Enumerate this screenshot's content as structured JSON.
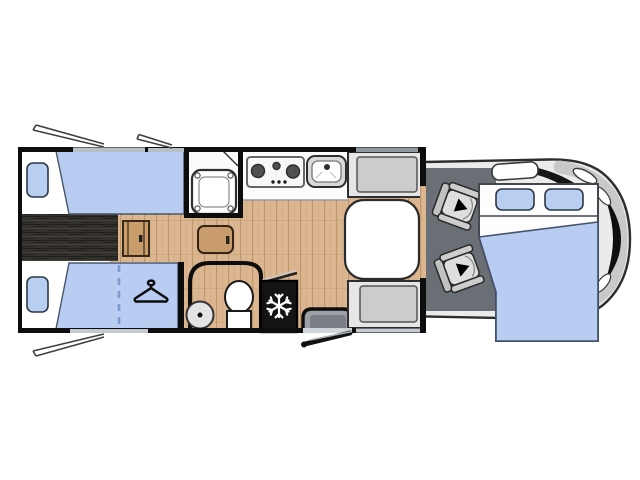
{
  "diagram": {
    "type": "motorhome-floorplan-top-view",
    "orientation": "vehicle front (cab) on the right, rear bedroom on the left",
    "colors": {
      "mattress_blue": "#b9cdf2",
      "wood_floor": "#dbb690",
      "dark_walkway": "#33312b",
      "wall_black": "#0d0d0d",
      "cab_body_gray": "#ebebeb",
      "cab_floor_gray": "#696f74",
      "bench_gray": "#cccccc",
      "fridge_black": "#141414",
      "window_sill_gray": "#c3c9cf"
    },
    "features": {
      "rear_bed_top": {
        "title": "Rear single bed (top)"
      },
      "rear_bed_bottom": {
        "title": "Rear single bed (bottom) with wardrobe under"
      },
      "rear_walkway": {
        "title": "Dark step walkway between rear beds"
      },
      "wardrobe": {
        "title": "Wardrobe (hanger symbol)"
      },
      "shower": {
        "title": "Shower cabin"
      },
      "stove": {
        "title": "Kitchen hob with 3 burners"
      },
      "sink": {
        "title": "Kitchen sink"
      },
      "bathroom": {
        "title": "Washroom with toilet"
      },
      "fridge": {
        "title": "Refrigerator (snowflake symbol)"
      },
      "entry_step": {
        "title": "Entrance step with open door"
      },
      "dinette_table": {
        "title": "Dinette table"
      },
      "dinette_bench_top": {
        "title": "Dinette bench seat (top)"
      },
      "dinette_bench_bottom": {
        "title": "Dinette bench seat (bottom)"
      },
      "cab": {
        "title": "Driver cab of vehicle"
      },
      "cab_seat_top": {
        "title": "Swivel cab seat (driver side)"
      },
      "cab_seat_bottom": {
        "title": "Swivel cab seat (passenger side)"
      },
      "front_bed": {
        "title": "Drop-down double bed over cab"
      },
      "windows": {
        "title": "Open window flaps"
      }
    },
    "icons": [
      "hanger-icon",
      "snowflake-icon",
      "seat-arrow-icon"
    ]
  }
}
